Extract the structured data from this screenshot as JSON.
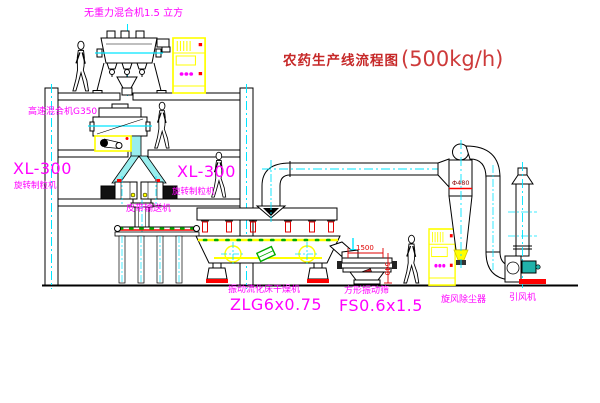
{
  "title": {
    "text": "农药生产线流程图",
    "capacity": "(500kg/h)"
  },
  "labels": {
    "top_mixer": "无重力混合机1.5 立方",
    "second_mixer": "高速混合机G350",
    "granulator_left": {
      "model": "XL-300",
      "name": "旋转制粒机"
    },
    "granulator_right": {
      "model": "XL-300",
      "name": "旋转制粒机"
    },
    "belt_conveyor": "皮带输送机",
    "dryer": {
      "name": "振动流化床干燥机",
      "model": "ZLG6x0.75"
    },
    "sieve": {
      "name": "方形振动筛",
      "model": "FS0.6x1.5"
    },
    "cyclone": "旋风除尘器",
    "fan": "引风机"
  },
  "annotations": {
    "cyclone_diameter": "Φ480",
    "sieve_dim_length": "1500",
    "sieve_dim_height": "540"
  },
  "colors": {
    "label_magenta": "#ff00ff",
    "title_red": "#c62828",
    "dimension_red": "#e00000",
    "cad_yellow": "#ffff00",
    "centerline_cyan": "#00e5ff",
    "dot_green": "#00aa00"
  }
}
